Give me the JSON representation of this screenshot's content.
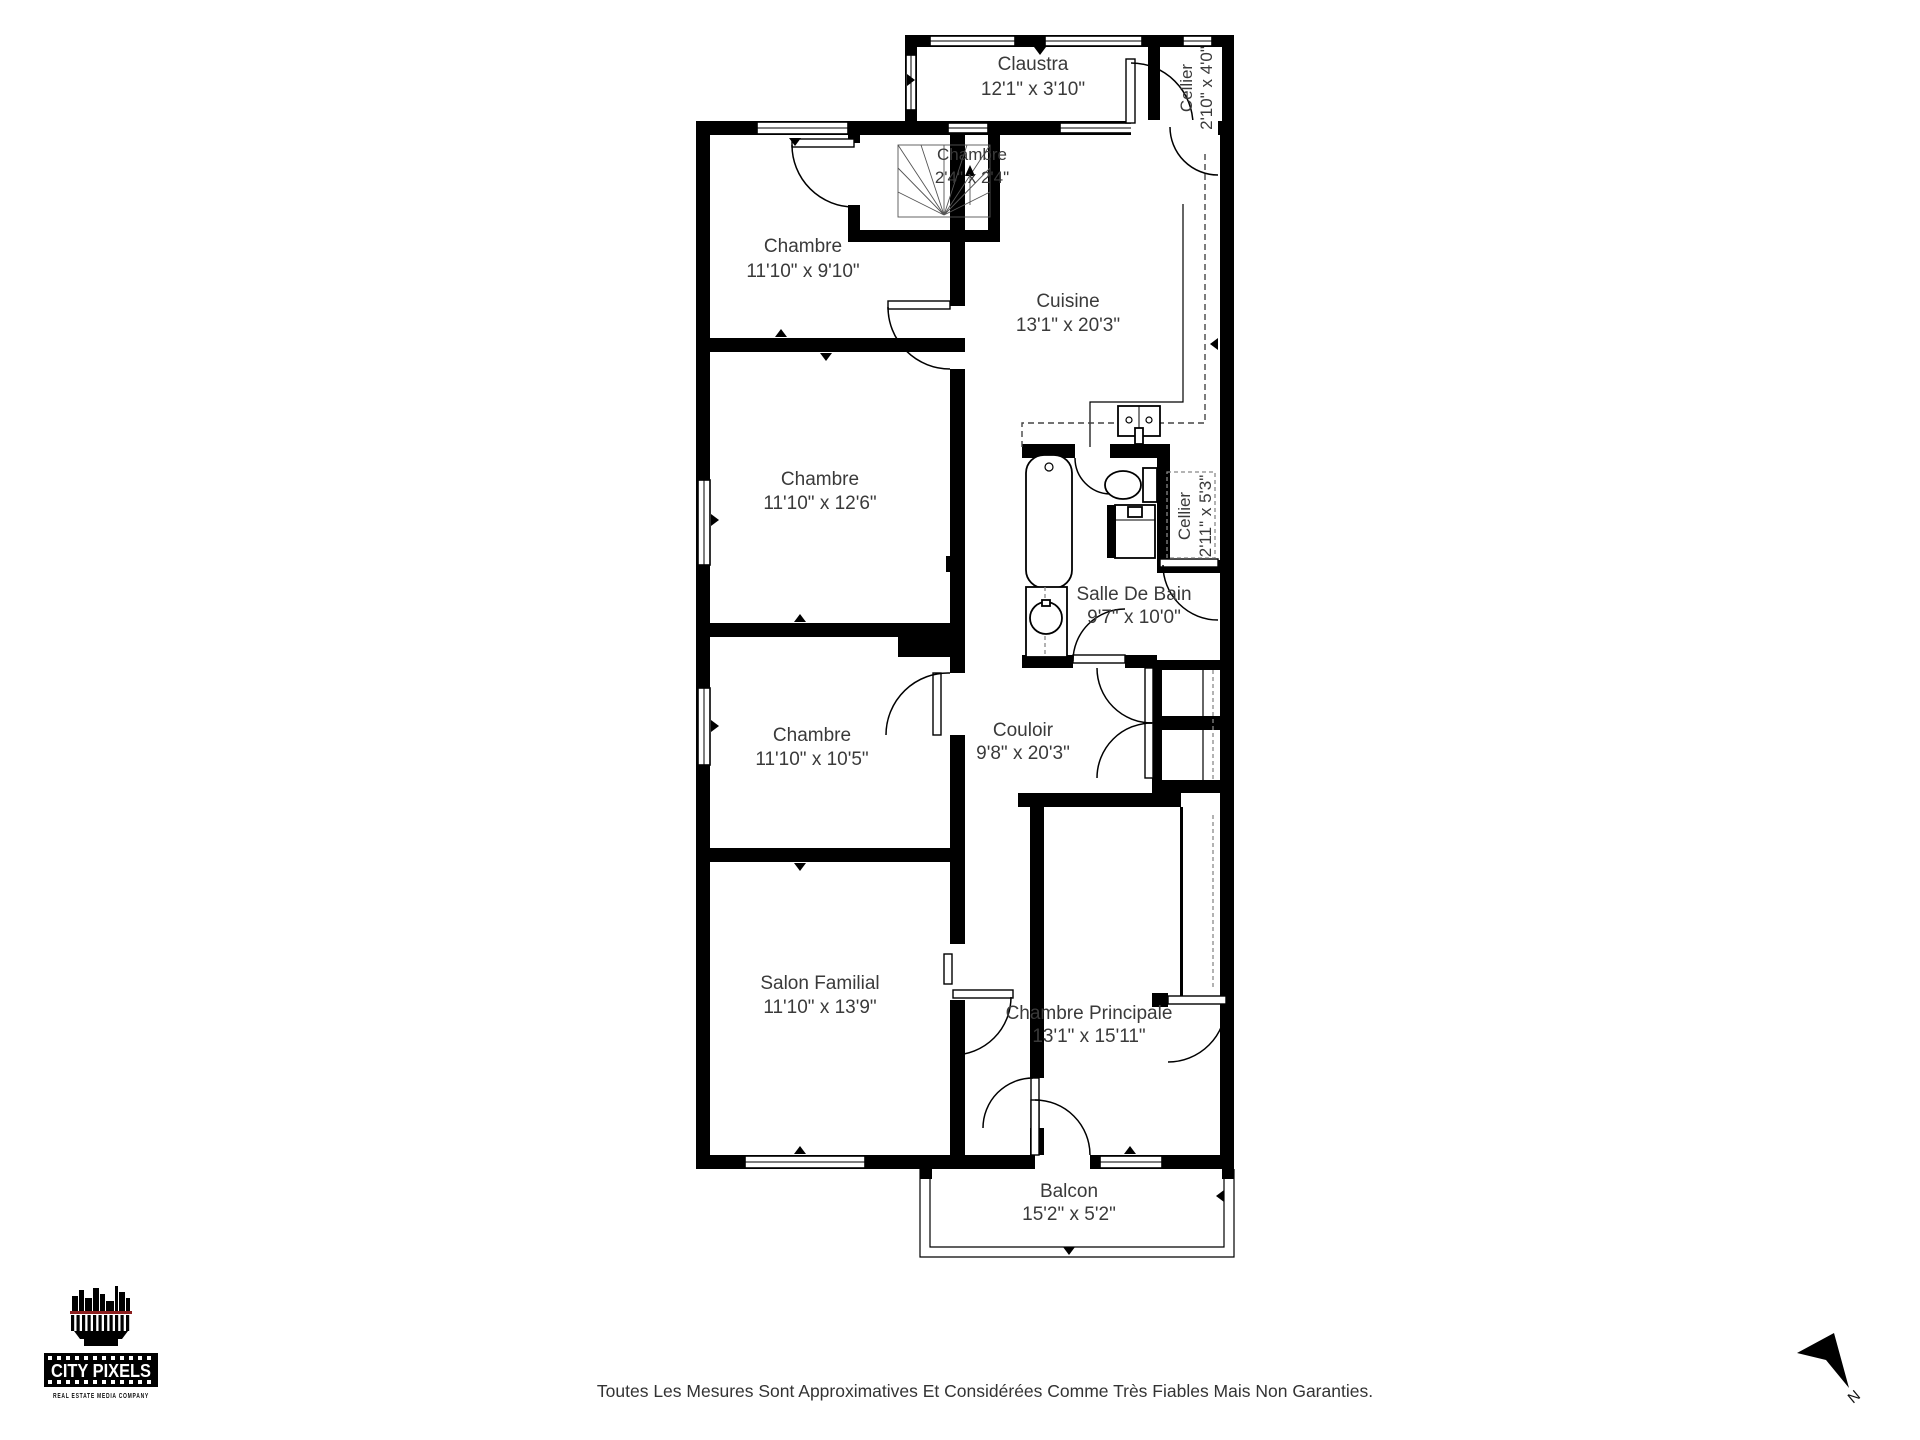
{
  "floorplan": {
    "rooms": {
      "claustra": {
        "name": "Claustra",
        "dims": "12'1\" x 3'10\""
      },
      "cellier_top": {
        "name": "Cellier",
        "dims": "2'10\" x 4'0\""
      },
      "stair_chambre": {
        "name": "Chambre",
        "dims": "2'4\" x 2'4\""
      },
      "chambre1": {
        "name": "Chambre",
        "dims": "11'10\" x 9'10\""
      },
      "cuisine": {
        "name": "Cuisine",
        "dims": "13'1\" x 20'3\""
      },
      "chambre2": {
        "name": "Chambre",
        "dims": "11'10\" x 12'6\""
      },
      "cellier_mid": {
        "name": "Cellier",
        "dims": "2'11\" x 5'3\""
      },
      "salle_de_bain": {
        "name": "Salle De Bain",
        "dims": "9'7\" x 10'0\""
      },
      "chambre3": {
        "name": "Chambre",
        "dims": "11'10\" x 10'5\""
      },
      "couloir": {
        "name": "Couloir",
        "dims": "9'8\" x 20'3\""
      },
      "salon": {
        "name": "Salon Familial",
        "dims": "11'10\" x 13'9\""
      },
      "chambre_principale": {
        "name": "Chambre Principale",
        "dims": "13'1\" x 15'11\""
      },
      "balcon": {
        "name": "Balcon",
        "dims": "15'2\" x 5'2\""
      }
    },
    "compass": {
      "label": "N"
    }
  },
  "branding": {
    "logo_title": "CITY PIXELS",
    "logo_subtitle": "REAL ESTATE MEDIA COMPANY"
  },
  "footer": {
    "disclaimer": "Toutes Les Mesures Sont Approximatives Et Considérées Comme Très Fiables Mais Non Garanties."
  },
  "colors": {
    "walls": "#000000",
    "label_text": "#3a3a3a",
    "logo_red": "#8b1e1e"
  }
}
